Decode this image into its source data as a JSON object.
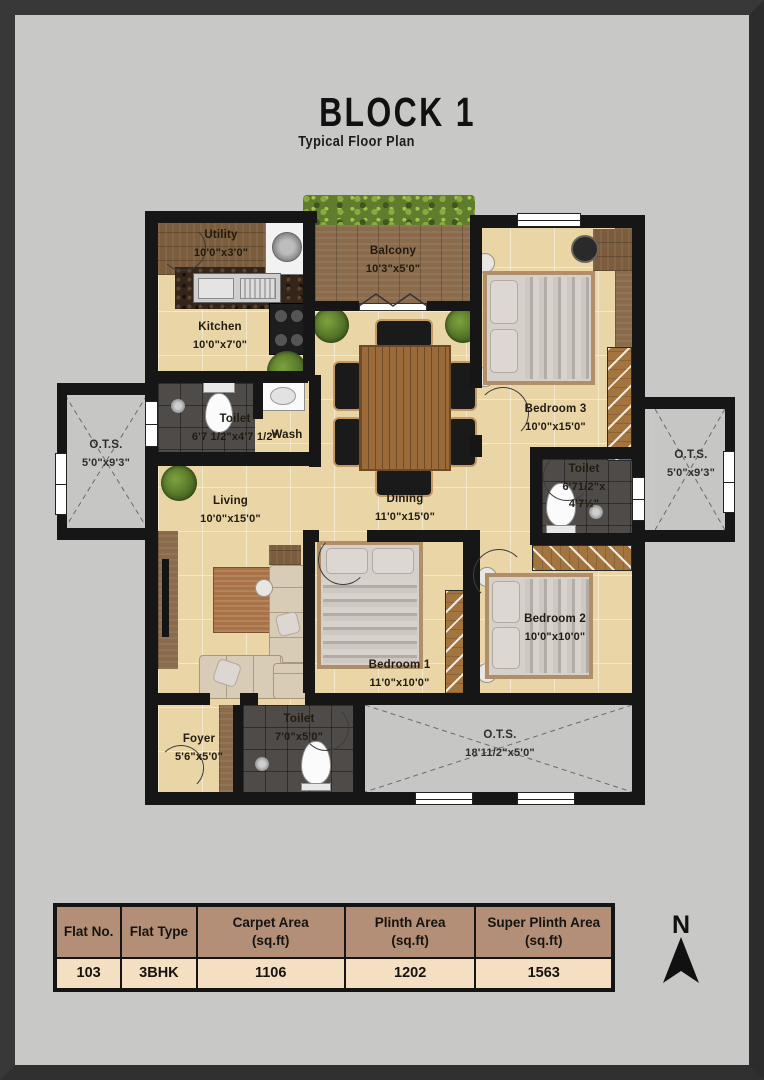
{
  "header": {
    "title": "BLOCK 1",
    "subtitle": "Typical Floor Plan"
  },
  "rooms": {
    "utility": {
      "name": "Utility",
      "dims": "10'0\"x3'0\""
    },
    "kitchen": {
      "name": "Kitchen",
      "dims": "10'0\"x7'0\""
    },
    "balcony": {
      "name": "Balcony",
      "dims": "10'3\"x5'0\""
    },
    "bedroom3": {
      "name": "Bedroom 3",
      "dims": "10'0\"x15'0\""
    },
    "toilet_common": {
      "name": "Toilet",
      "dims": "6'7 1/2\"x4'7 1/2\""
    },
    "wash": {
      "name": "Wash"
    },
    "ots_left": {
      "name": "O.T.S.",
      "dims": "5'0\"x9'3\""
    },
    "ots_right": {
      "name": "O.T.S.",
      "dims": "5'0\"x9'3\""
    },
    "dining": {
      "name": "Dining",
      "dims": "11'0\"x15'0\""
    },
    "living": {
      "name": "Living",
      "dims": "10'0\"x15'0\""
    },
    "toilet_bed3": {
      "name": "Toilet",
      "dims_line1": "6'71/2\"x",
      "dims_line2": "4'7½\""
    },
    "bedroom1": {
      "name": "Bedroom 1",
      "dims": "11'0\"x10'0\""
    },
    "bedroom2": {
      "name": "Bedroom 2",
      "dims": "10'0\"x10'0\""
    },
    "foyer": {
      "name": "Foyer",
      "dims": "5'6\"x5'0\""
    },
    "toilet_bottom": {
      "name": "Toilet",
      "dims": "7'0\"x5'0\""
    },
    "ots_bottom": {
      "name": "O.T.S.",
      "dims": "18'11/2\"x5'0\""
    }
  },
  "compass": {
    "label": "N"
  },
  "area_table": {
    "headers": [
      "Flat No.",
      "Flat Type",
      "Carpet Area\n(sq.ft)",
      "Plinth Area\n(sq.ft)",
      "Super Plinth Area\n(sq.ft)"
    ],
    "row": [
      "103",
      "3BHK",
      "1106",
      "1202",
      "1563"
    ]
  },
  "colors": {
    "page_bg": "#c8c8c6",
    "frame": "#383838",
    "wall": "#161616",
    "floor_tile": "#e9d5a6",
    "dark_tile": "#4e4b49",
    "wood": "#8a6b4c",
    "hedge_green": "#5f7d2c",
    "table_header_bg": "#b28f76",
    "table_row_bg": "#f5dfc2"
  }
}
